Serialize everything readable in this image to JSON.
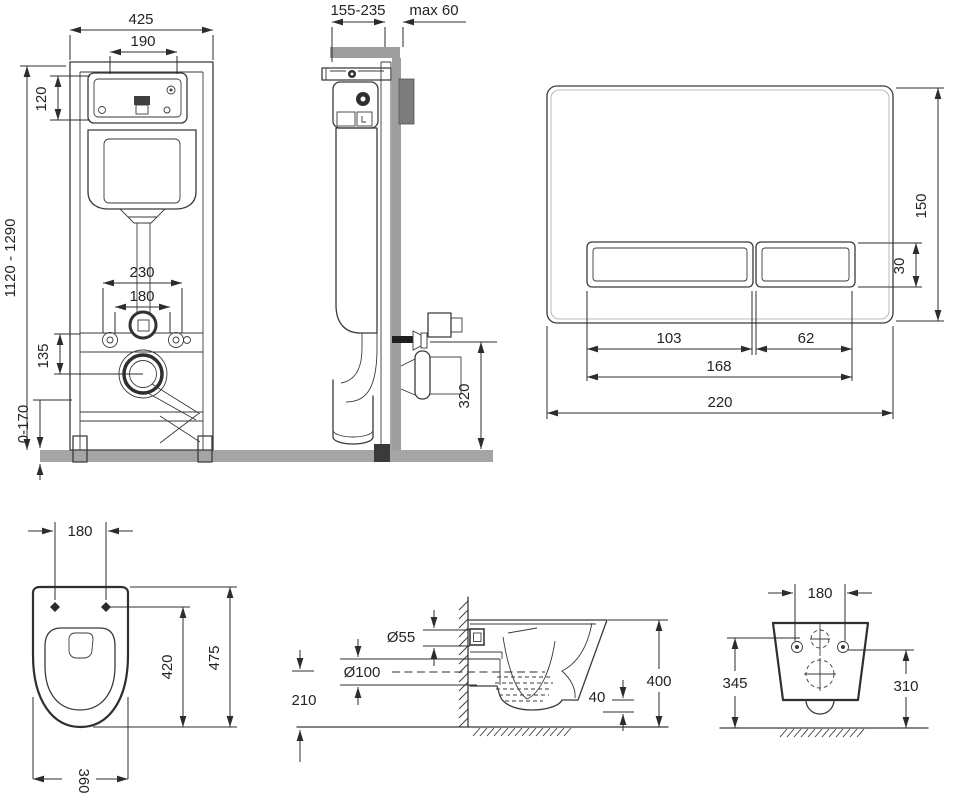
{
  "colors": {
    "line": "#3a3a3a",
    "dimension": "#2c2c2c",
    "wall_gray": "#9e9e9e",
    "floor_gray": "#a5a5a5",
    "bracket_dark": "#7c7c7c",
    "fitting_black": "#1f1f1f"
  },
  "views": {
    "frame_front": {
      "dims": {
        "total_width": "425",
        "tank_width": "190",
        "window_height": "120",
        "install_height": "1120 - 1290",
        "fix_spacing_outer": "230",
        "fix_spacing_inner": "180",
        "drain_drop": "135",
        "foot_range": "0-170"
      }
    },
    "frame_side": {
      "dims": {
        "frame_depth": "155-235",
        "wall_max": "max 60",
        "outlet_height": "320"
      }
    },
    "flush_plate": {
      "dims": {
        "plate_height": "150",
        "button_height": "30",
        "left_button_width": "103",
        "right_button_width": "62",
        "buttons_width": "168",
        "plate_width": "220"
      }
    },
    "bowl_top": {
      "dims": {
        "hole_spacing": "180",
        "seat_length": "420",
        "bowl_length": "475",
        "bowl_width": "360"
      }
    },
    "bowl_side": {
      "dims": {
        "inlet_diameter": "Ø55",
        "outlet_diameter": "Ø100",
        "outlet_height": "210",
        "trap_drop": "40",
        "bowl_height": "400"
      }
    },
    "bowl_rear": {
      "dims": {
        "hole_spacing": "180",
        "height_left": "345",
        "height_right": "310"
      }
    }
  }
}
